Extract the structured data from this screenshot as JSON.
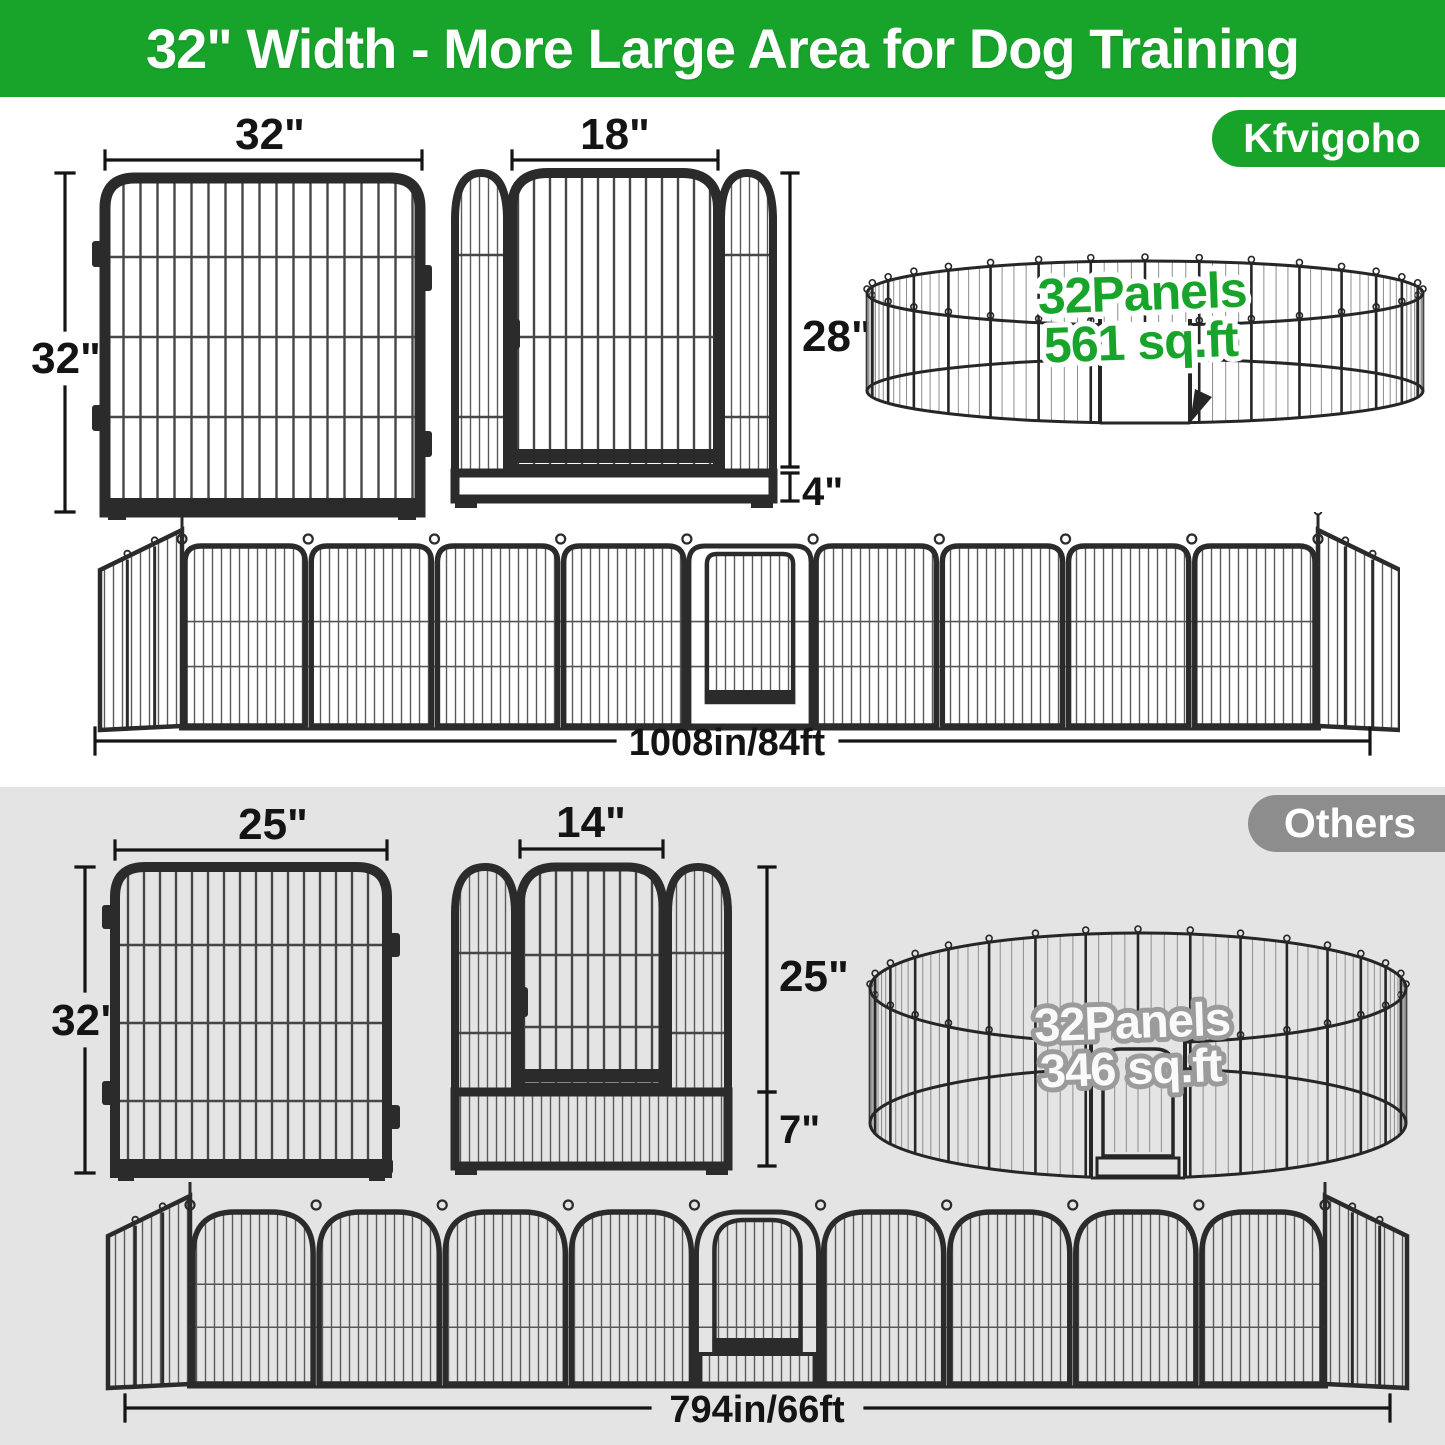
{
  "header": {
    "title": "32\" Width - More Large Area for Dog Training"
  },
  "badges": {
    "brand": "Kfvigoho",
    "others": "Others"
  },
  "colors": {
    "brand_green": "#18a32b",
    "others_gray": "#8d8d8d",
    "others_section_bg": "#e4e4e4",
    "frame_dark": "#2b2b2b",
    "ink": "#141414"
  },
  "kfvigoho": {
    "panel": {
      "width": "32\"",
      "height": "32\""
    },
    "gate": {
      "width": "18\"",
      "door_height": "28\"",
      "bottom_height": "4\""
    },
    "ring": {
      "panels": "32Panels",
      "area": "561 sq.ft"
    },
    "row": {
      "length": "1008in/84ft"
    }
  },
  "others": {
    "panel": {
      "width": "25\"",
      "height": "32\""
    },
    "gate": {
      "width": "14\"",
      "door_height": "25\"",
      "bottom_height": "7\""
    },
    "ring": {
      "panels": "32Panels",
      "area": "346 sq.ft"
    },
    "row": {
      "length": "794in/66ft"
    }
  }
}
